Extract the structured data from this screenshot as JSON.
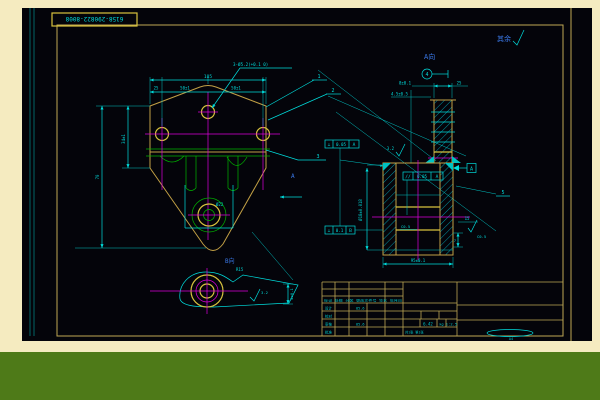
{
  "colors": {
    "page_background": "#f5ebc0",
    "bottom_bar": "#4e7a18",
    "canvas": "#04040a",
    "frame_yellow": "#bfa854",
    "geometry_yellow": "#d8c23e",
    "line_cyan": "#00dcdc",
    "line_magenta": "#dd00dd",
    "line_green": "#00b400",
    "label_blue": "#3a78e8"
  },
  "title_box": {
    "drawing_number": "6158-290822-8008"
  },
  "notes": {
    "surface_default_label": "其余",
    "view_a_label": "A向",
    "view_b_label": "B向"
  },
  "front_view": {
    "hole_callout": "3-Ø5.2(+0.1 0)",
    "dim_overall_width": "105",
    "dim_seg_left": "25",
    "dim_seg_mid": "50±1",
    "dim_seg_right": "50±1",
    "dim_height": "70",
    "dim_side_height": "34±1",
    "dim_boss": "Ø22",
    "balloon_1": "1",
    "balloon_2": "2",
    "balloon_3": "3",
    "section_arrow_label": "A"
  },
  "section_view": {
    "balloon_4": "4",
    "balloon_5": "5",
    "dim_top_width": "8±0.1",
    "dim_top_right": "25",
    "dim_top_left": "4.5±0.5",
    "dim_right_top": "15",
    "dim_right_step": "7",
    "dim_bottom_width": "95±0.1",
    "bore_dim": "Ø18±0.018",
    "roughness_top": "3.2",
    "chamfer_1": "C0.5",
    "chamfer_2": "C0.5",
    "datum_a": "A",
    "fcf_perp_top": {
      "symbol": "⊥",
      "tolerance": "0.05",
      "datum": "A"
    },
    "fcf_parallel": {
      "symbol": "//",
      "tolerance": "0.05",
      "datum": "A"
    },
    "fcf_perp_bottom": {
      "symbol": "⊥",
      "tolerance": "0.1",
      "datum": "B"
    }
  },
  "detail_view": {
    "radius_label": "R15",
    "roughness": "3.2",
    "dim_depth": "4±0.1"
  },
  "title_block": {
    "revision_header": "标记 处数 分区 更改文件号 签名 年月日",
    "rows": [
      {
        "label": "设计",
        "value": "85.6"
      },
      {
        "label": "校对",
        "value": ""
      },
      {
        "label": "审核",
        "value": "85.6"
      },
      {
        "label": "批准",
        "value": ""
      }
    ],
    "weight_value": "6.42",
    "weight_unit": "kg",
    "scale_value": "1:2.5",
    "sheet_note": "共1张 第1张",
    "paper_size": "A4"
  }
}
